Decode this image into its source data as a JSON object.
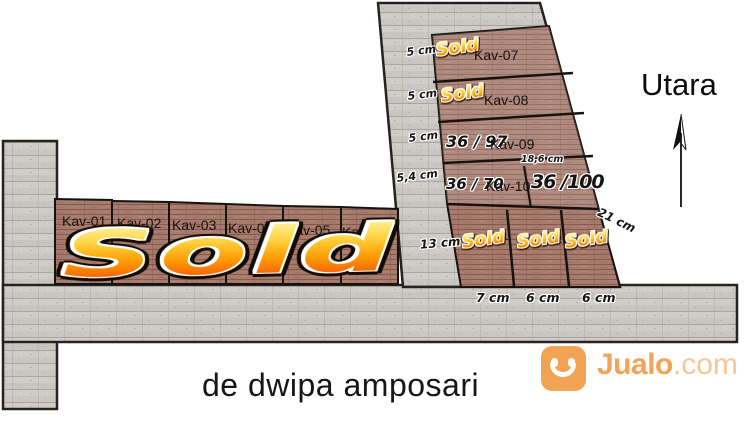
{
  "compass": {
    "label": "Utara"
  },
  "footer": {
    "title": "de dwipa amposari"
  },
  "watermark": {
    "brand": "Jualo",
    "tld": ".com"
  },
  "left_block": {
    "status": "Sold",
    "plots": [
      {
        "label": "Kav-01"
      },
      {
        "label": "Kav-02"
      },
      {
        "label": "Kav-03"
      },
      {
        "label": "Kav-04"
      },
      {
        "label": "Kav-05"
      },
      {
        "label": "Kav-06"
      }
    ]
  },
  "right_block": {
    "rows": [
      {
        "label": "Kav-07",
        "side_dim": "5 cm",
        "status": "Sold"
      },
      {
        "label": "Kav-08",
        "side_dim": "5 cm",
        "status": "Sold"
      },
      {
        "label": "Kav-09",
        "side_dim": "5 cm",
        "size": "36 / 97"
      },
      {
        "label": "Kav-10",
        "side_dim": "5,4 cm",
        "size": "36 / 70",
        "extra_size": "36 /100",
        "extra_width": "18,6 cm"
      }
    ],
    "left_dim": "13 cm",
    "right_dim": "21 cm",
    "bottom_plots": [
      {
        "no": "1",
        "status": "Sold",
        "width": "7 cm"
      },
      {
        "no": "2",
        "status": "Sold",
        "width": "6 cm"
      },
      {
        "no": "3",
        "status": "Sold",
        "width": "6 cm"
      }
    ]
  },
  "colors": {
    "sold_orange": "#ff9800",
    "sold_yellow": "#ffd23e",
    "plot_brown": "#a67c6f",
    "road_gray": "#c9c5c1",
    "brand_orange": "#f1a456"
  }
}
